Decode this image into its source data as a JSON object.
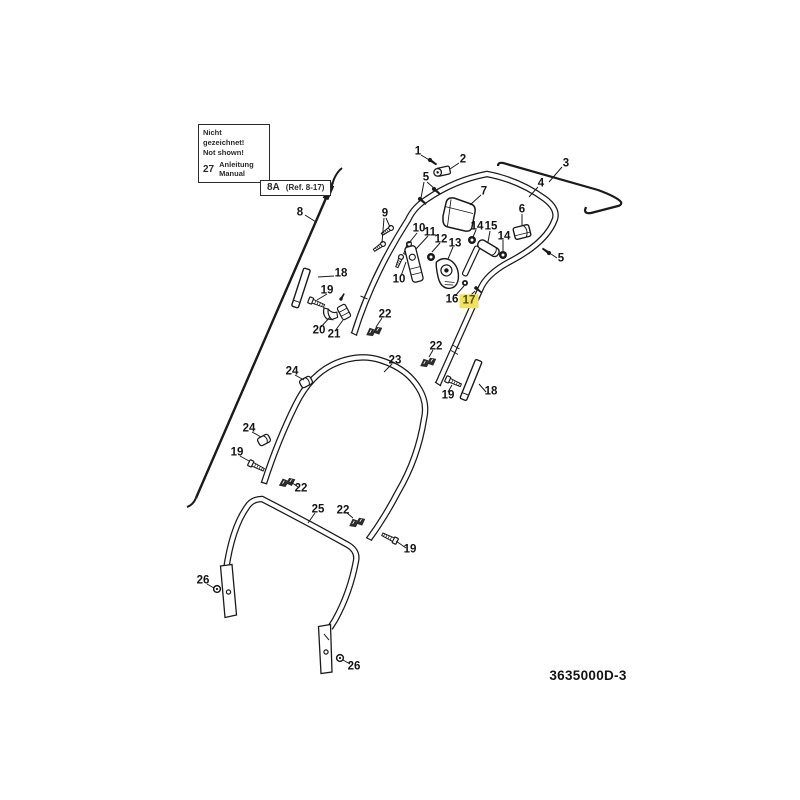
{
  "legend": {
    "line1": "Nicht gezeichnet!",
    "line2": "Not shown!",
    "item_number": "27",
    "item_name_de": "Anleitung",
    "item_name_en": "Manual"
  },
  "ref_label": {
    "code": "8A",
    "detail": "(Ref. 8-17)"
  },
  "drawing_number": "3635000D-3",
  "highlighted_part": "17",
  "colors": {
    "line": "#1a1a1a",
    "highlight": "#f2e159",
    "background": "#ffffff"
  },
  "part_labels": [
    {
      "text": "1"
    },
    {
      "text": "2"
    },
    {
      "text": "5"
    },
    {
      "text": "3"
    },
    {
      "text": "4"
    },
    {
      "text": "7"
    },
    {
      "text": "6"
    },
    {
      "text": "9"
    },
    {
      "text": "10"
    },
    {
      "text": "11"
    },
    {
      "text": "12"
    },
    {
      "text": "13"
    },
    {
      "text": "14"
    },
    {
      "text": "15"
    },
    {
      "text": "14"
    },
    {
      "text": "5"
    },
    {
      "text": "8"
    },
    {
      "text": "10"
    },
    {
      "text": "16"
    },
    {
      "text": "17",
      "highlighted": true
    },
    {
      "text": "18"
    },
    {
      "text": "19"
    },
    {
      "text": "20"
    },
    {
      "text": "21"
    },
    {
      "text": "22"
    },
    {
      "text": "22"
    },
    {
      "text": "19"
    },
    {
      "text": "18"
    },
    {
      "text": "23"
    },
    {
      "text": "24"
    },
    {
      "text": "24"
    },
    {
      "text": "19"
    },
    {
      "text": "22"
    },
    {
      "text": "25"
    },
    {
      "text": "22"
    },
    {
      "text": "19"
    },
    {
      "text": "26"
    },
    {
      "text": "26"
    }
  ]
}
